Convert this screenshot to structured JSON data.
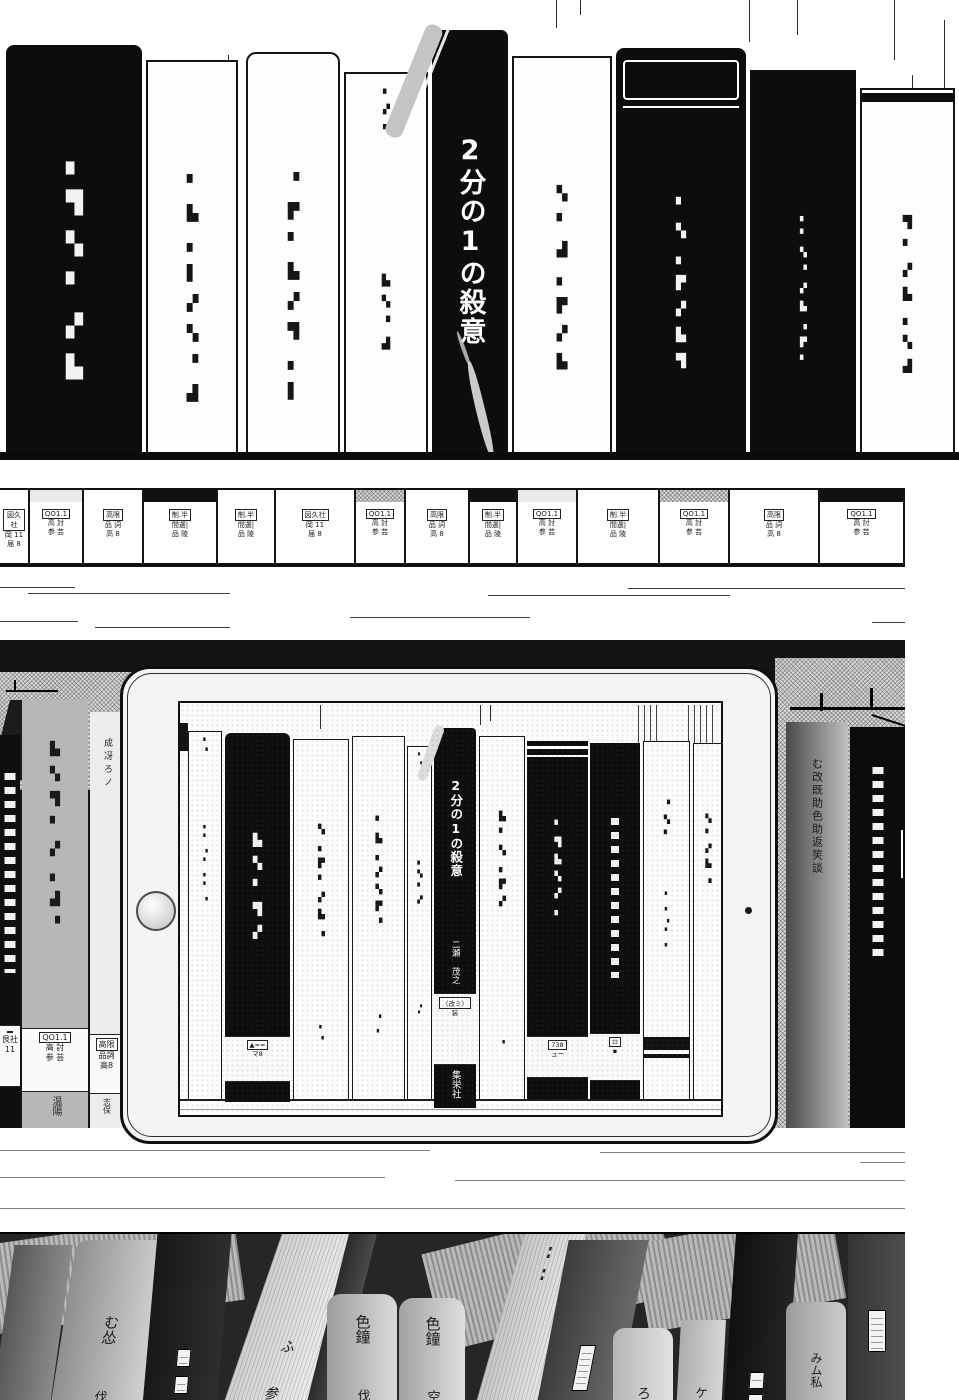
{
  "colors": {
    "ink": "#111111",
    "paper": "#ffffff",
    "black_book": "#0d0d0d",
    "halftone_gray": "#c4c4c4",
    "shadow_bg": "#141414"
  },
  "featured_book": {
    "title": "2分の1の殺意",
    "author": "二瀬 茂之",
    "publisher": "集栄社",
    "edition_label": "〈改ミ〉",
    "edition_sub": "装"
  },
  "top_shelf": {
    "books": [
      {
        "x": 6,
        "w": 136,
        "top": 45,
        "color": "black",
        "r": "8px 8px 0 0",
        "marks": [
          {
            "t": "▖▜▚▘▞▙",
            "top": 105,
            "fs": 22,
            "ls": 16
          }
        ]
      },
      {
        "x": 146,
        "w": 92,
        "top": 60,
        "color": "white",
        "marks": [
          {
            "t": "▘▙▖▌▞▚▝▟",
            "top": 112,
            "fs": 15,
            "ls": 12
          }
        ]
      },
      {
        "x": 246,
        "w": 94,
        "top": 52,
        "color": "white",
        "r": "10px 10px 0 0",
        "marks": [
          {
            "t": "▝▛▘▙▞▜▖▌",
            "top": 118,
            "fs": 15,
            "ls": 12
          }
        ]
      },
      {
        "x": 344,
        "w": 84,
        "top": 72,
        "color": "white",
        "marks": [
          {
            "t": "▘▞▖",
            "top": 16,
            "fs": 9,
            "ls": 5
          },
          {
            "t": "▙▚▝▟",
            "top": 200,
            "fs": 11,
            "ls": 8
          }
        ]
      },
      {
        "x": 432,
        "w": 76,
        "top": 30,
        "color": "black",
        "r": "7px 7px 0 0",
        "featured": "big"
      },
      {
        "x": 512,
        "w": 100,
        "top": 56,
        "color": "white",
        "marks": [
          {
            "t": "▚▘▟▖▛▞▙",
            "top": 128,
            "fs": 14,
            "ls": 12
          }
        ]
      },
      {
        "x": 616,
        "w": 130,
        "top": 48,
        "color": "black",
        "r": "8px 8px 0 0",
        "frame": true,
        "marks": [
          {
            "t": "▘▚▖▛▞▙▜",
            "top": 150,
            "fs": 13,
            "ls": 11
          }
        ]
      },
      {
        "x": 750,
        "w": 106,
        "top": 70,
        "color": "black",
        "marks": [
          {
            "t": "▖▘▚▝▞▙▗▛▘",
            "top": 142,
            "fs": 9,
            "ls": 8
          }
        ]
      },
      {
        "x": 860,
        "w": 95,
        "top": 88,
        "color": "white",
        "topband": true,
        "marks": [
          {
            "t": "▜▘▞▙▖▚▟",
            "top": 125,
            "fs": 12,
            "ls": 10
          }
        ]
      }
    ]
  },
  "spine_row": {
    "presets": {
      "L1": {
        "box": "QO1.1",
        "l1": "高 討",
        "l2": "参 芸"
      },
      "L2": {
        "box": "高限",
        "l1": "品 詞",
        "l2": "高 8"
      },
      "L3": {
        "box": "制.半",
        "l1": "間選|",
        "l2": "品 陵"
      },
      "L4": {
        "box": "図久社",
        "l1": "岡 11",
        "l2": "届 8"
      }
    },
    "books": [
      {
        "w": 30,
        "topStyle": "plain",
        "label": "L4"
      },
      {
        "w": 54,
        "topStyle": "dot",
        "label": "L1"
      },
      {
        "w": 60,
        "topStyle": "plain",
        "label": "L2"
      },
      {
        "w": 74,
        "topStyle": "black",
        "label": "L3"
      },
      {
        "w": 58,
        "topStyle": "plain",
        "label": "L3"
      },
      {
        "w": 80,
        "topStyle": "plain",
        "label": "L4"
      },
      {
        "w": 50,
        "topStyle": "check",
        "label": "L1"
      },
      {
        "w": 64,
        "topStyle": "plain",
        "label": "L2"
      },
      {
        "w": 48,
        "topStyle": "black",
        "label": "L3"
      },
      {
        "w": 60,
        "topStyle": "dot",
        "label": "L1"
      },
      {
        "w": 82,
        "topStyle": "plain",
        "label": "L3"
      },
      {
        "w": 70,
        "topStyle": "check",
        "label": "L1"
      },
      {
        "w": 90,
        "topStyle": "plain",
        "label": "L2"
      },
      {
        "w": 85,
        "topStyle": "black",
        "label": "L1"
      }
    ]
  },
  "behind_tablet": {
    "left_books": [
      {
        "x": 0,
        "w": 20,
        "top": 735,
        "bg": "#0f0f0f",
        "blocks": {
          "top": 38,
          "h": 200
        },
        "labelSec": {
          "top": 290,
          "h": 60,
          "box": "",
          "l1": "艮社",
          "l2": "11"
        }
      },
      {
        "x": 22,
        "w": 66,
        "top": 700,
        "bg": "#b7b7b7",
        "ht": true,
        "marks": [
          {
            "t": "▙▚▜▘▞▖▟▝",
            "top": 42,
            "fs": 13,
            "ls": 10,
            "c": "#1b1b1b"
          }
        ],
        "labelSec": {
          "top": 328,
          "h": 62,
          "box": "QO1.1",
          "l1": "高 討",
          "l2": "参 芸"
        },
        "tail": {
          "t": "温陽",
          "top": 396,
          "fs": 10
        }
      },
      {
        "x": 90,
        "w": 33,
        "top": 712,
        "bg": "#ececec",
        "marks": [
          {
            "t": "成冴ろノ",
            "top": 26,
            "fs": 9,
            "ls": 4,
            "c": "#222"
          }
        ],
        "labelSec": {
          "top": 322,
          "h": 58,
          "box": "高限",
          "l1": "品詞",
          "l2": "高8"
        },
        "tail": {
          "t": "志保",
          "top": 386,
          "fs": 8
        }
      }
    ],
    "right_books": [
      {
        "x": 786,
        "w": 62,
        "top": 722,
        "grad": [
          "#4a4a4a",
          "#c0c0c0"
        ],
        "marks": [
          {
            "t": "む改既助色助返笑談",
            "top": 36,
            "fs": 11,
            "ls": 2,
            "c": "#191919"
          }
        ]
      },
      {
        "x": 850,
        "w": 55,
        "top": 727,
        "bg": "#0c0c0c",
        "blocks": {
          "top": 40,
          "h": 195
        }
      }
    ]
  },
  "tablet": {
    "screen_books": [
      {
        "x": 8,
        "w": 34,
        "top": 28,
        "color": "white",
        "marks": [
          {
            "t": "▘▝",
            "top": 6,
            "fs": 6,
            "ls": 3
          },
          {
            "t": "▖▘▗▘▖▘▗",
            "top": 90,
            "fs": 6,
            "ls": 5
          }
        ]
      },
      {
        "x": 45,
        "w": 65,
        "top": 30,
        "color": "black",
        "r": "6px 6px 0 0",
        "bottom": 399,
        "marks": [
          {
            "t": "▙▚▘▜▞",
            "top": 100,
            "fs": 12,
            "ls": 9
          },
          {
            "t": "▘",
            "top": 335,
            "fs": 7
          }
        ],
        "label": {
          "top": 303,
          "h": 44,
          "boxed": "▲==",
          "sub": "マ8"
        }
      },
      {
        "x": 113,
        "w": 56,
        "top": 36,
        "color": "white",
        "marks": [
          {
            "t": "▚▖▛▘▞▙▗",
            "top": 85,
            "fs": 9,
            "ls": 7
          },
          {
            "t": "▖▗",
            "top": 282,
            "fs": 6,
            "ls": 4
          }
        ]
      },
      {
        "x": 172,
        "w": 53,
        "top": 33,
        "color": "white",
        "marks": [
          {
            "t": "▘▙▖▞▚▛▝",
            "top": 80,
            "fs": 9,
            "ls": 7
          },
          {
            "t": "▝▖",
            "top": 278,
            "fs": 6,
            "ls": 4
          }
        ]
      },
      {
        "x": 227,
        "w": 25,
        "top": 43,
        "color": "white",
        "marks": [
          {
            "t": "▘▝",
            "top": 6,
            "fs": 5,
            "ls": 3
          },
          {
            "t": "▖▚▘▞",
            "top": 110,
            "fs": 7,
            "ls": 5
          },
          {
            "t": "▗▘",
            "top": 255,
            "fs": 5,
            "ls": 3
          }
        ]
      },
      {
        "x": 254,
        "w": 42,
        "top": 25,
        "color": "black",
        "bottom": 405,
        "r": "4px 4px 0 0",
        "featured": "small"
      },
      {
        "x": 299,
        "w": 46,
        "top": 33,
        "color": "white",
        "marks": [
          {
            "t": "▙▘▚▖▛▞",
            "top": 75,
            "fs": 9,
            "ls": 7
          },
          {
            "t": "▗",
            "top": 300,
            "fs": 6,
            "ls": 3
          }
        ]
      },
      {
        "x": 347,
        "w": 61,
        "top": 38,
        "color": "black",
        "band": true,
        "marks": [
          {
            "t": "▘▜▙▚▞▖",
            "top": 80,
            "fs": 9,
            "ls": 7
          }
        ],
        "label": {
          "top": 295,
          "h": 40,
          "boxed": "738",
          "sub": "ュー"
        }
      },
      {
        "x": 410,
        "w": 50,
        "top": 40,
        "color": "black",
        "dotcol": {
          "top": 75,
          "h": 160
        },
        "label": {
          "top": 290,
          "h": 46,
          "boxed": "⊡",
          "sub": "▪"
        }
      },
      {
        "x": 463,
        "w": 47,
        "top": 38,
        "color": "white",
        "bands": true,
        "marks": [
          {
            "t": "▝▚▘",
            "top": 58,
            "fs": 8,
            "ls": 6
          },
          {
            "t": "▘▖▗▘▖",
            "top": 150,
            "fs": 6,
            "ls": 5
          }
        ]
      },
      {
        "x": 513,
        "w": 30,
        "top": 40,
        "color": "white",
        "marks": [
          {
            "t": "▚▘▞▙▗",
            "top": 70,
            "fs": 8,
            "ls": 6
          }
        ]
      }
    ]
  },
  "bottom_shelf": {
    "books": [
      {
        "x": -12,
        "w": 58,
        "top": 11,
        "skew": -8,
        "grad": [
          "#585858",
          "#8a8a8a"
        ]
      },
      {
        "x": 46,
        "w": 94,
        "top": 6,
        "skew": -9,
        "r": "12px 12px 0 0",
        "grad": [
          "#8f8f8f",
          "#d2d2d2"
        ],
        "marks": [
          {
            "t": "む怂",
            "top": 75,
            "fs": 15
          },
          {
            "t": "伐",
            "top": 150,
            "fs": 13
          }
        ]
      },
      {
        "x": 140,
        "w": 74,
        "top": 0,
        "skew": -5,
        "grad": [
          "#181818",
          "#2e2e2e"
        ],
        "labels": [
          {
            "top": 115,
            "w": 12,
            "h": 16
          },
          {
            "top": 142,
            "w": 12,
            "h": 16
          }
        ]
      },
      {
        "x": 213,
        "w": 88,
        "top": 0,
        "skew": -19,
        "grad": [
          "#cfcfcf",
          "#ededed"
        ],
        "pages": true,
        "marks": [
          {
            "t": "ふ",
            "top": 105,
            "fs": 14
          },
          {
            "t": "参",
            "top": 152,
            "fs": 14
          }
        ]
      },
      {
        "x": 299,
        "w": 28,
        "top": 0,
        "skew": -14,
        "grad": [
          "#2b2b2b",
          "#4a4a4a"
        ]
      },
      {
        "x": 327,
        "w": 70,
        "top": 60,
        "skew": 0,
        "r": "14px 14px 0 0",
        "grad": [
          "#9c9c9c",
          "#dadada"
        ],
        "marks": [
          {
            "t": "色鐘",
            "top": 20,
            "fs": 15
          },
          {
            "t": "伐",
            "top": 95,
            "fs": 13
          }
        ]
      },
      {
        "x": 399,
        "w": 66,
        "top": 64,
        "skew": 0,
        "r": "14px 14px 0 0",
        "grad": [
          "#a2a2a2",
          "#dedede"
        ],
        "marks": [
          {
            "t": "色鐘",
            "top": 18,
            "fs": 15
          },
          {
            "t": "空",
            "top": 92,
            "fs": 13
          }
        ]
      },
      {
        "x": 467,
        "w": 62,
        "top": 0,
        "skew": -16,
        "pages": true,
        "grad": [
          "#c6c6c6",
          "#e6e6e6"
        ],
        "marks": [
          {
            "t": "▖▘▖▘",
            "top": 10,
            "fs": 6,
            "ls": 4
          }
        ]
      },
      {
        "x": 531,
        "w": 80,
        "top": 6,
        "skew": -11,
        "grad": [
          "#3c3c3c",
          "#6a6a6a"
        ],
        "labels": [
          {
            "top": 105,
            "w": 14,
            "h": 44
          }
        ]
      },
      {
        "x": 613,
        "w": 60,
        "top": 94,
        "skew": 0,
        "r": "12px 12px 0 0",
        "grad": [
          "#b5b5b5",
          "#e2e2e2"
        ],
        "marks": [
          {
            "t": "ろ",
            "top": 58,
            "fs": 14
          }
        ]
      },
      {
        "x": 675,
        "w": 45,
        "top": 86,
        "skew": -3,
        "grad": [
          "#adadad",
          "#d6d6d6"
        ],
        "marks": [
          {
            "t": "ケ",
            "top": 66,
            "fs": 13
          }
        ]
      },
      {
        "x": 722,
        "w": 62,
        "top": 0,
        "skew": -4,
        "grad": [
          "#101010",
          "#242424"
        ],
        "labels": [
          {
            "top": 138,
            "w": 13,
            "h": 15
          },
          {
            "top": 160,
            "w": 13,
            "h": 15
          }
        ]
      },
      {
        "x": 786,
        "w": 60,
        "top": 68,
        "skew": 0,
        "r": "10px 10px 0 0",
        "grad": [
          "#9b9b9b",
          "#cdcdcd"
        ],
        "marks": [
          {
            "t": "みム私",
            "top": 50,
            "fs": 12
          }
        ]
      },
      {
        "x": 848,
        "w": 57,
        "top": 0,
        "skew": 0,
        "grad": [
          "#353535",
          "#4e4e4e"
        ],
        "labels": [
          {
            "top": 76,
            "w": 16,
            "h": 40
          }
        ]
      }
    ]
  }
}
